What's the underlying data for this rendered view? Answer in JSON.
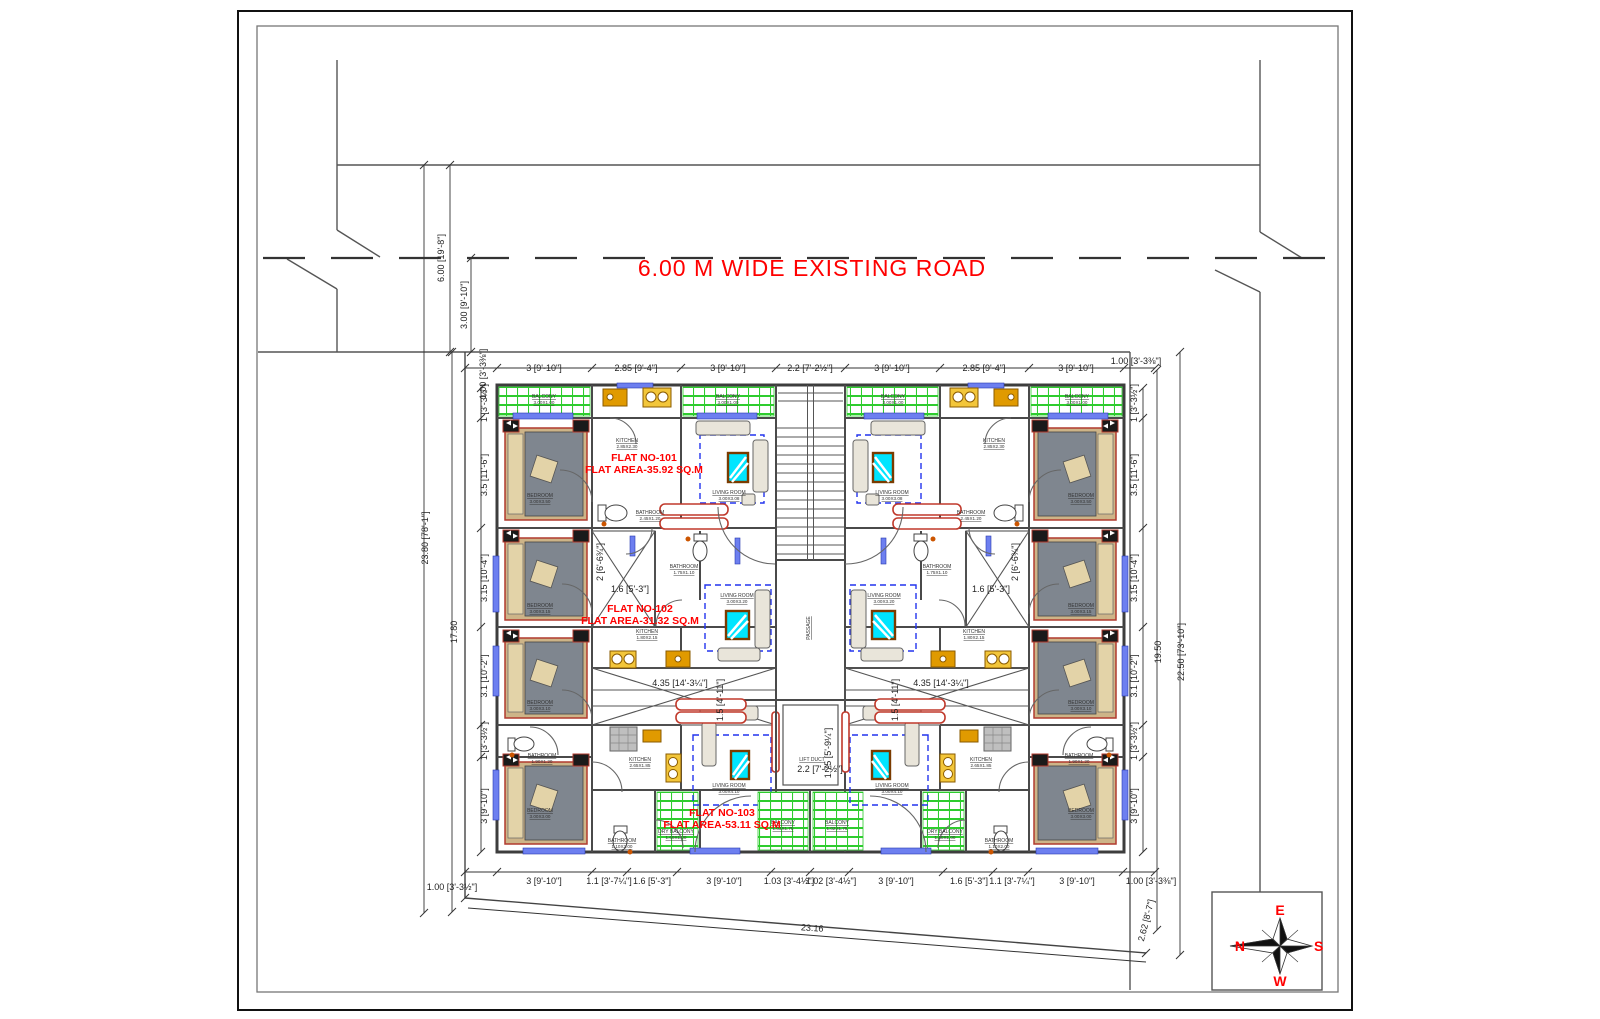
{
  "road": {
    "label": "6.00 M WIDE EXISTING ROAD"
  },
  "flat_labels": [
    {
      "line1": "FLAT NO-101",
      "line2": "FLAT AREA-35.92 SQ.M",
      "x": 644,
      "y": 461
    },
    {
      "line1": "FLAT NO-102",
      "line2": "FLAT AREA-31.32 SQ.M",
      "x": 640,
      "y": 612
    },
    {
      "line1": "FLAT NO-103",
      "line2": "FLAT AREA-53.11 SQ.M",
      "x": 722,
      "y": 816
    }
  ],
  "dims": [
    {
      "t": "1.00 [3'-3⅜\"]",
      "x": 486,
      "y": 374,
      "r": -90
    },
    {
      "t": "3 [9'-10\"]",
      "x": 544,
      "y": 371
    },
    {
      "t": "2.85 [9'-4\"]",
      "x": 636,
      "y": 371
    },
    {
      "t": "3 [9'-10\"]",
      "x": 728,
      "y": 371
    },
    {
      "t": "2.2 [7'-2½\"]",
      "x": 810,
      "y": 371
    },
    {
      "t": "3 [9'-10\"]",
      "x": 892,
      "y": 371
    },
    {
      "t": "2.85 [9'-4\"]",
      "x": 984,
      "y": 371
    },
    {
      "t": "3 [9'-10\"]",
      "x": 1076,
      "y": 371
    },
    {
      "t": "1.00 [3'-3⅜\"]",
      "x": 1136,
      "y": 364
    },
    {
      "t": "1 [3'-3½\"]",
      "x": 487,
      "y": 403,
      "r": -90
    },
    {
      "t": "3.5 [11'-6\"]",
      "x": 487,
      "y": 475,
      "r": -90
    },
    {
      "t": "3.15 [10'-4\"]",
      "x": 487,
      "y": 578,
      "r": -90
    },
    {
      "t": "3.1 [10'-2\"]",
      "x": 487,
      "y": 676,
      "r": -90
    },
    {
      "t": "1 [3'-3½\"]",
      "x": 487,
      "y": 741,
      "r": -90
    },
    {
      "t": "3 [9'-10\"]",
      "x": 487,
      "y": 806,
      "r": -90
    },
    {
      "t": "1 [3'-3½\"]",
      "x": 1137,
      "y": 403,
      "r": -90
    },
    {
      "t": "3.5 [11'-6\"]",
      "x": 1137,
      "y": 475,
      "r": -90
    },
    {
      "t": "3.15 [10'-4\"]",
      "x": 1137,
      "y": 578,
      "r": -90
    },
    {
      "t": "3.1 [10'-2\"]",
      "x": 1137,
      "y": 676,
      "r": -90
    },
    {
      "t": "1 [3'-3½\"]",
      "x": 1137,
      "y": 741,
      "r": -90
    },
    {
      "t": "3 [9'-10\"]",
      "x": 1137,
      "y": 806,
      "r": -90
    },
    {
      "t": "23.80 [78'-1\"]",
      "x": 428,
      "y": 538,
      "r": -90
    },
    {
      "t": "17.80",
      "x": 457,
      "y": 632,
      "r": -90
    },
    {
      "t": "19.50",
      "x": 1161,
      "y": 652,
      "r": -90
    },
    {
      "t": "22.50 [73'-10\"]",
      "x": 1184,
      "y": 652,
      "r": -90
    },
    {
      "t": "6.00 [19'-8\"]",
      "x": 444,
      "y": 258,
      "r": -90
    },
    {
      "t": "3.00 [9'-10\"]",
      "x": 467,
      "y": 305,
      "r": -90
    },
    {
      "t": "1.00 [3'-3½\"]",
      "x": 452,
      "y": 890
    },
    {
      "t": "3 [9'-10\"]",
      "x": 544,
      "y": 884
    },
    {
      "t": "1.1 [3'-7¼\"]",
      "x": 609,
      "y": 884
    },
    {
      "t": "1.6 [5'-3\"]",
      "x": 652,
      "y": 884
    },
    {
      "t": "3 [9'-10\"]",
      "x": 724,
      "y": 884
    },
    {
      "t": "1.03 [3'-4½\"]",
      "x": 789,
      "y": 884
    },
    {
      "t": "1.02 [3'-4½\"]",
      "x": 831,
      "y": 884
    },
    {
      "t": "3 [9'-10\"]",
      "x": 896,
      "y": 884
    },
    {
      "t": "1.6 [5'-3\"]",
      "x": 969,
      "y": 884
    },
    {
      "t": "1.1 [3'-7¼\"]",
      "x": 1012,
      "y": 884
    },
    {
      "t": "3 [9'-10\"]",
      "x": 1077,
      "y": 884
    },
    {
      "t": "1.00 [3'-3⅜\"]",
      "x": 1151,
      "y": 884
    },
    {
      "t": "2 [6'-6¾\"]",
      "x": 603,
      "y": 562,
      "r": -90
    },
    {
      "t": "1.6 [5'-3\"]",
      "x": 630,
      "y": 592
    },
    {
      "t": "2 [6'-6¾\"]",
      "x": 1018,
      "y": 562,
      "r": -90
    },
    {
      "t": "1.6 [5'-3\"]",
      "x": 991,
      "y": 592
    },
    {
      "t": "4.35 [14'-3¼\"]",
      "x": 680,
      "y": 686
    },
    {
      "t": "1.5 [4'-11\"]",
      "x": 723,
      "y": 700,
      "r": -90
    },
    {
      "t": "4.35 [14'-3¼\"]",
      "x": 941,
      "y": 686
    },
    {
      "t": "1.5 [4'-11\"]",
      "x": 898,
      "y": 700,
      "r": -90
    },
    {
      "t": "2.2 [7'-2½\"]",
      "x": 820,
      "y": 772
    },
    {
      "t": "1.75 [5'-9¼\"]",
      "x": 831,
      "y": 753,
      "r": -90
    },
    {
      "t": "23.16",
      "x": 812,
      "y": 931,
      "r": 4
    },
    {
      "t": "2.62 [8'-7\"]",
      "x": 1149,
      "y": 921,
      "r": -76
    }
  ],
  "room_labels": [
    {
      "n": "BALCONY",
      "s": "3.00X1.00",
      "x": 544,
      "y": 398
    },
    {
      "n": "BALCONY",
      "s": "3.00X1.00",
      "x": 728,
      "y": 398
    },
    {
      "n": "BALCONY",
      "s": "3.00X1.00",
      "x": 893,
      "y": 398
    },
    {
      "n": "BALCONY",
      "s": "3.00X1.00",
      "x": 1077,
      "y": 398
    },
    {
      "n": "KITCHEN",
      "s": "2.85X2.30",
      "x": 627,
      "y": 442
    },
    {
      "n": "KITCHEN",
      "s": "2.85X2.30",
      "x": 994,
      "y": 442
    },
    {
      "n": "BEDROOM",
      "s": "3.00X3.50",
      "x": 540,
      "y": 497
    },
    {
      "n": "BEDROOM",
      "s": "3.00X3.50",
      "x": 1081,
      "y": 497
    },
    {
      "n": "BATHROOM",
      "s": "2.45X1.20",
      "x": 650,
      "y": 514
    },
    {
      "n": "BATHROOM",
      "s": "2.45X1.20",
      "x": 971,
      "y": 514
    },
    {
      "n": "LIVING ROOM",
      "s": "3.00X3.08",
      "x": 729,
      "y": 494
    },
    {
      "n": "LIVING ROOM",
      "s": "3.00X3.08",
      "x": 892,
      "y": 494
    },
    {
      "n": "BEDROOM",
      "s": "3.00X3.15",
      "x": 540,
      "y": 607
    },
    {
      "n": "BEDROOM",
      "s": "3.00X3.15",
      "x": 1081,
      "y": 607
    },
    {
      "n": "BATHROOM",
      "s": "1.75X1.10",
      "x": 684,
      "y": 568
    },
    {
      "n": "BATHROOM",
      "s": "1.75X1.10",
      "x": 937,
      "y": 568
    },
    {
      "n": "LIVING ROOM",
      "s": "3.00X3.20",
      "x": 737,
      "y": 597
    },
    {
      "n": "LIVING ROOM",
      "s": "3.00X3.20",
      "x": 884,
      "y": 597
    },
    {
      "n": "KITCHEN",
      "s": "1.80X2.15",
      "x": 647,
      "y": 633
    },
    {
      "n": "KITCHEN",
      "s": "1.80X2.15",
      "x": 974,
      "y": 633
    },
    {
      "n": "BEDROOM",
      "s": "3.00X3.10",
      "x": 540,
      "y": 704
    },
    {
      "n": "BEDROOM",
      "s": "3.00X3.10",
      "x": 1081,
      "y": 704
    },
    {
      "n": "BATHROOM",
      "s": "1.90X1.20",
      "x": 542,
      "y": 757
    },
    {
      "n": "BATHROOM",
      "s": "1.90X1.20",
      "x": 1079,
      "y": 757
    },
    {
      "n": "KITCHEN",
      "s": "2.65X1.85",
      "x": 640,
      "y": 761
    },
    {
      "n": "KITCHEN",
      "s": "2.65X1.85",
      "x": 981,
      "y": 761
    },
    {
      "n": "LIVING ROOM",
      "s": "3.00X4.10",
      "x": 729,
      "y": 787
    },
    {
      "n": "LIVING ROOM",
      "s": "3.00X4.10",
      "x": 892,
      "y": 787
    },
    {
      "n": "BEDROOM",
      "s": "3.00X3.00",
      "x": 540,
      "y": 812
    },
    {
      "n": "BEDROOM",
      "s": "3.00X3.00",
      "x": 1081,
      "y": 812
    },
    {
      "n": "BATHROOM",
      "s": "1.10X2.00",
      "x": 622,
      "y": 842
    },
    {
      "n": "BATHROOM",
      "s": "1.10X2.00",
      "x": 999,
      "y": 842
    },
    {
      "n": "DRY BALCONY",
      "s": "1.60X1.00",
      "x": 676,
      "y": 833
    },
    {
      "n": "DRY BALCONY",
      "s": "1.60X1.00",
      "x": 945,
      "y": 833
    },
    {
      "n": "PASSAGE",
      "s": "",
      "x": 810,
      "y": 628,
      "v": true
    },
    {
      "n": "LIFT DUCT",
      "s": "",
      "x": 812,
      "y": 761
    },
    {
      "n": "BALCONY",
      "s": "1.03X1.75",
      "x": 783,
      "y": 824
    },
    {
      "n": "BALCONY",
      "s": "1.02X1.75",
      "x": 837,
      "y": 824
    }
  ],
  "compass": {
    "e": "E",
    "s": "S",
    "w": "W",
    "n": "N"
  },
  "colors": {
    "accent_red": "#ff0000",
    "tile_green": "#2ecc2e",
    "window_blue": "#6d7ff0",
    "tv_cyan": "#00e5ff",
    "counter_orange": "#e09a00",
    "counter_gold": "#c8960c",
    "wall_gray": "#4a4a4a",
    "dashed_blue": "#2233ee",
    "marker_red": "#c0392b"
  }
}
